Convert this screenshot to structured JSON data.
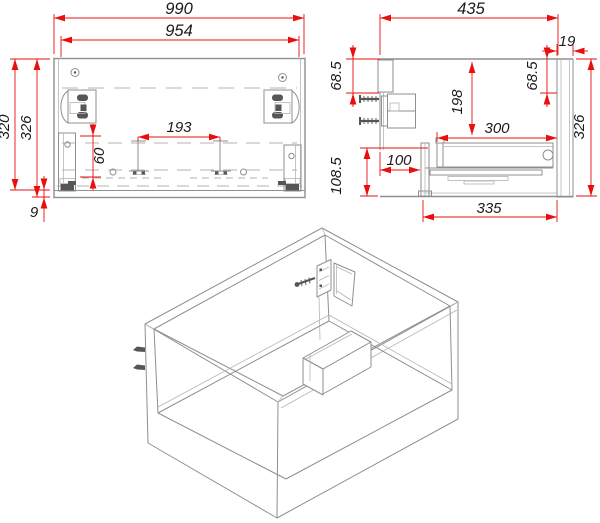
{
  "drawing_type": "cabinet assembly technical drawing",
  "colors": {
    "dimension_red": "#e8100f",
    "outline_gray": "#8f8f8f",
    "hardware_dark": "#565656",
    "text": "#1b1b1b",
    "background": "#ffffff"
  },
  "front_view": {
    "dimensions": {
      "overall_width": "990",
      "inner_width": "954",
      "height_outer": "320",
      "height_inner": "326",
      "bottom_gap": "9",
      "rail_height": "60",
      "clip_spacing": "193"
    }
  },
  "side_view": {
    "dimensions": {
      "overall_depth": "435",
      "front_panel_thickness": "19",
      "hanger_offset_left": "68.5",
      "hanger_offset_right": "68.5",
      "back_panel_height": "198",
      "drawer_depth": "300",
      "overall_height": "326",
      "bottom_section_height": "108.5",
      "back_clearance": "100",
      "slide_length": "335"
    }
  }
}
